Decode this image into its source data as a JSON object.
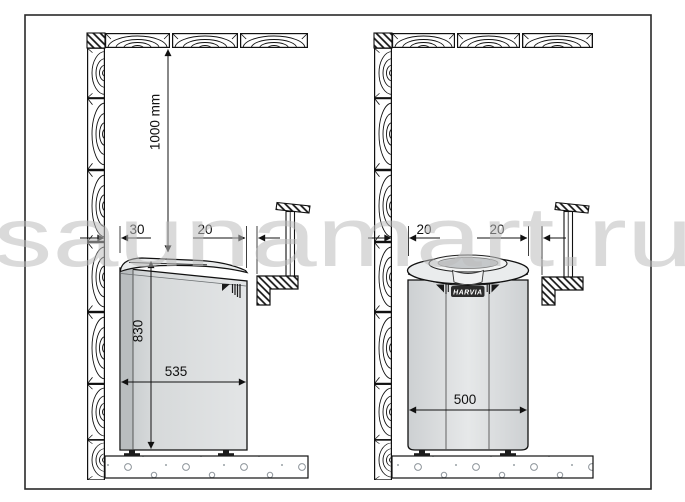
{
  "watermark": {
    "text": "saunamart.ru",
    "color": "#bcbcbc"
  },
  "left_panel": {
    "clearance_top": "1000 mm",
    "gap_wall": "30",
    "gap_rail": "20",
    "heater_height": "830",
    "heater_depth": "535"
  },
  "right_panel": {
    "gap_wall": "20",
    "gap_rail": "20",
    "heater_width": "500",
    "heater_brand": "HARVIA"
  }
}
